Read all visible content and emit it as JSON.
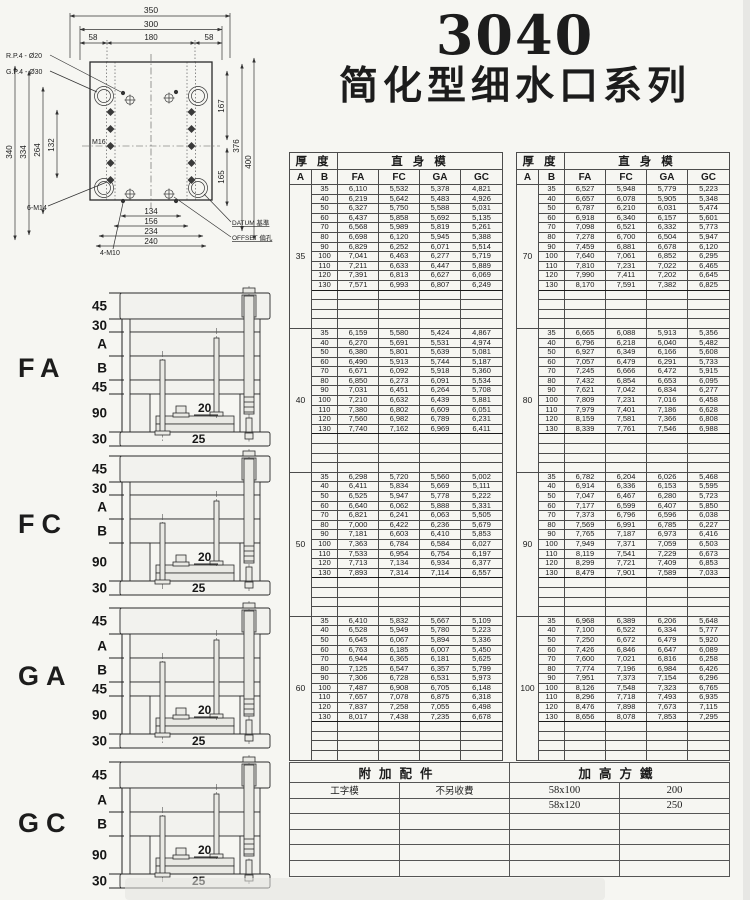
{
  "colors": {
    "paper": "#f6f6f2",
    "ink": "#1c1c1c"
  },
  "title": {
    "model": "3040",
    "series": "简化型细水口系列"
  },
  "drawing": {
    "dims_top": [
      "350",
      "300",
      "58",
      "180",
      "58"
    ],
    "dims_left": [
      "340",
      "334",
      "264",
      "132"
    ],
    "dims_right": [
      "167",
      "165",
      "376",
      "400"
    ],
    "dims_bottom": [
      "134",
      "156",
      "234",
      "240"
    ],
    "labels": {
      "rp4": "R.P.4 - Ø20",
      "gp4": "G.P.4 - Ø30",
      "m14": "6-M14",
      "m10": "4-M10",
      "m16": "M16",
      "datum": "DATUM 基準",
      "offset": "OFFSET 偏孔"
    }
  },
  "sections": [
    {
      "label": "FA",
      "dims": [
        "45",
        "30",
        "A",
        "B",
        "45",
        "90",
        "30"
      ],
      "inner": [
        "20",
        "25"
      ]
    },
    {
      "label": "FC",
      "dims": [
        "45",
        "30",
        "A",
        "B",
        "90",
        "30"
      ],
      "inner": [
        "20",
        "25"
      ]
    },
    {
      "label": "GA",
      "dims": [
        "45",
        "A",
        "B",
        "45",
        "90",
        "30"
      ],
      "inner": [
        "20",
        "25"
      ]
    },
    {
      "label": "GC",
      "dims": [
        "45",
        "A",
        "B",
        "90",
        "30"
      ],
      "inner": [
        "20",
        "25"
      ]
    }
  ],
  "price_tables": [
    {
      "header": {
        "thickness": "厚 度",
        "body": "直 身 模",
        "cols": [
          "A",
          "B",
          "FA",
          "FC",
          "GA",
          "GC"
        ]
      },
      "blocks": [
        {
          "a": "35",
          "empty_rows": 4,
          "rows": [
            [
              "35",
              "6,110",
              "5,532",
              "5,378",
              "4,821"
            ],
            [
              "40",
              "6,219",
              "5,642",
              "5,483",
              "4,926"
            ],
            [
              "50",
              "6,327",
              "5,750",
              "5,588",
              "5,031"
            ],
            [
              "60",
              "6,437",
              "5,858",
              "5,692",
              "5,135"
            ],
            [
              "70",
              "6,568",
              "5,989",
              "5,819",
              "5,261"
            ],
            [
              "80",
              "6,698",
              "6,120",
              "5,945",
              "5,388"
            ],
            [
              "90",
              "6,829",
              "6,252",
              "6,071",
              "5,514"
            ],
            [
              "100",
              "7,041",
              "6,463",
              "6,277",
              "5,719"
            ],
            [
              "110",
              "7,211",
              "6,633",
              "6,447",
              "5,889"
            ],
            [
              "120",
              "7,391",
              "6,813",
              "6,627",
              "6,069"
            ],
            [
              "130",
              "7,571",
              "6,993",
              "6,807",
              "6,249"
            ]
          ]
        },
        {
          "a": "40",
          "empty_rows": 4,
          "rows": [
            [
              "35",
              "6,159",
              "5,580",
              "5,424",
              "4,867"
            ],
            [
              "40",
              "6,270",
              "5,691",
              "5,531",
              "4,974"
            ],
            [
              "50",
              "6,380",
              "5,801",
              "5,639",
              "5,081"
            ],
            [
              "60",
              "6,490",
              "5,913",
              "5,744",
              "5,187"
            ],
            [
              "70",
              "6,671",
              "6,092",
              "5,918",
              "5,360"
            ],
            [
              "80",
              "6,850",
              "6,273",
              "6,091",
              "5,534"
            ],
            [
              "90",
              "7,031",
              "6,451",
              "6,264",
              "5,708"
            ],
            [
              "100",
              "7,210",
              "6,632",
              "6,439",
              "5,881"
            ],
            [
              "110",
              "7,380",
              "6,802",
              "6,609",
              "6,051"
            ],
            [
              "120",
              "7,560",
              "6,982",
              "6,789",
              "6,231"
            ],
            [
              "130",
              "7,740",
              "7,162",
              "6,969",
              "6,411"
            ]
          ]
        },
        {
          "a": "50",
          "empty_rows": 4,
          "rows": [
            [
              "35",
              "6,298",
              "5,720",
              "5,560",
              "5,002"
            ],
            [
              "40",
              "6,411",
              "5,834",
              "5,669",
              "5,111"
            ],
            [
              "50",
              "6,525",
              "5,947",
              "5,778",
              "5,222"
            ],
            [
              "60",
              "6,640",
              "6,062",
              "5,888",
              "5,331"
            ],
            [
              "70",
              "6,821",
              "6,241",
              "6,063",
              "5,505"
            ],
            [
              "80",
              "7,000",
              "6,422",
              "6,236",
              "5,679"
            ],
            [
              "90",
              "7,181",
              "6,603",
              "6,410",
              "5,853"
            ],
            [
              "100",
              "7,363",
              "6,784",
              "6,584",
              "6,027"
            ],
            [
              "110",
              "7,533",
              "6,954",
              "6,754",
              "6,197"
            ],
            [
              "120",
              "7,713",
              "7,134",
              "6,934",
              "6,377"
            ],
            [
              "130",
              "7,893",
              "7,314",
              "7,114",
              "6,557"
            ]
          ]
        },
        {
          "a": "60",
          "empty_rows": 4,
          "rows": [
            [
              "35",
              "6,410",
              "5,832",
              "5,667",
              "5,109"
            ],
            [
              "40",
              "6,528",
              "5,949",
              "5,780",
              "5,223"
            ],
            [
              "50",
              "6,645",
              "6,067",
              "5,894",
              "5,336"
            ],
            [
              "60",
              "6,763",
              "6,185",
              "6,007",
              "5,450"
            ],
            [
              "70",
              "6,944",
              "6,365",
              "6,181",
              "5,625"
            ],
            [
              "80",
              "7,125",
              "6,547",
              "6,357",
              "5,799"
            ],
            [
              "90",
              "7,306",
              "6,728",
              "6,531",
              "5,973"
            ],
            [
              "100",
              "7,487",
              "6,908",
              "6,705",
              "6,148"
            ],
            [
              "110",
              "7,657",
              "7,078",
              "6,875",
              "6,318"
            ],
            [
              "120",
              "7,837",
              "7,258",
              "7,055",
              "6,498"
            ],
            [
              "130",
              "8,017",
              "7,438",
              "7,235",
              "6,678"
            ]
          ]
        }
      ]
    },
    {
      "header": {
        "thickness": "厚 度",
        "body": "直 身 模",
        "cols": [
          "A",
          "B",
          "FA",
          "FC",
          "GA",
          "GC"
        ]
      },
      "blocks": [
        {
          "a": "70",
          "empty_rows": 4,
          "rows": [
            [
              "35",
              "6,527",
              "5,948",
              "5,779",
              "5,223"
            ],
            [
              "40",
              "6,657",
              "6,078",
              "5,905",
              "5,348"
            ],
            [
              "50",
              "6,787",
              "6,210",
              "6,031",
              "5,474"
            ],
            [
              "60",
              "6,918",
              "6,340",
              "6,157",
              "5,601"
            ],
            [
              "70",
              "7,098",
              "6,521",
              "6,332",
              "5,773"
            ],
            [
              "80",
              "7,278",
              "6,700",
              "6,504",
              "5,947"
            ],
            [
              "90",
              "7,459",
              "6,881",
              "6,678",
              "6,120"
            ],
            [
              "100",
              "7,640",
              "7,061",
              "6,852",
              "6,295"
            ],
            [
              "110",
              "7,810",
              "7,231",
              "7,022",
              "6,465"
            ],
            [
              "120",
              "7,990",
              "7,411",
              "7,202",
              "6,645"
            ],
            [
              "130",
              "8,170",
              "7,591",
              "7,382",
              "6,825"
            ]
          ]
        },
        {
          "a": "80",
          "empty_rows": 4,
          "rows": [
            [
              "35",
              "6,665",
              "6,088",
              "5,913",
              "5,356"
            ],
            [
              "40",
              "6,796",
              "6,218",
              "6,040",
              "5,482"
            ],
            [
              "50",
              "6,927",
              "6,349",
              "6,166",
              "5,608"
            ],
            [
              "60",
              "7,057",
              "6,479",
              "6,291",
              "5,733"
            ],
            [
              "70",
              "7,245",
              "6,666",
              "6,472",
              "5,915"
            ],
            [
              "80",
              "7,432",
              "6,854",
              "6,653",
              "6,095"
            ],
            [
              "90",
              "7,621",
              "7,042",
              "6,834",
              "6,277"
            ],
            [
              "100",
              "7,809",
              "7,231",
              "7,016",
              "6,458"
            ],
            [
              "110",
              "7,979",
              "7,401",
              "7,186",
              "6,628"
            ],
            [
              "120",
              "8,159",
              "7,581",
              "7,366",
              "6,808"
            ],
            [
              "130",
              "8,339",
              "7,761",
              "7,546",
              "6,988"
            ]
          ]
        },
        {
          "a": "90",
          "empty_rows": 4,
          "rows": [
            [
              "35",
              "6,782",
              "6,204",
              "6,026",
              "5,468"
            ],
            [
              "40",
              "6,914",
              "6,336",
              "6,153",
              "5,595"
            ],
            [
              "50",
              "7,047",
              "6,467",
              "6,280",
              "5,723"
            ],
            [
              "60",
              "7,177",
              "6,599",
              "6,407",
              "5,850"
            ],
            [
              "70",
              "7,373",
              "6,796",
              "6,596",
              "6,038"
            ],
            [
              "80",
              "7,569",
              "6,991",
              "6,785",
              "6,227"
            ],
            [
              "90",
              "7,765",
              "7,187",
              "6,973",
              "6,416"
            ],
            [
              "100",
              "7,949",
              "7,371",
              "7,059",
              "6,503"
            ],
            [
              "110",
              "8,119",
              "7,541",
              "7,229",
              "6,673"
            ],
            [
              "120",
              "8,299",
              "7,721",
              "7,409",
              "6,853"
            ],
            [
              "130",
              "8,479",
              "7,901",
              "7,589",
              "7,033"
            ]
          ]
        },
        {
          "a": "100",
          "empty_rows": 4,
          "rows": [
            [
              "35",
              "6,968",
              "6,389",
              "6,206",
              "5,648"
            ],
            [
              "40",
              "7,100",
              "6,522",
              "6,334",
              "5,777"
            ],
            [
              "50",
              "7,250",
              "6,672",
              "6,479",
              "5,920"
            ],
            [
              "60",
              "7,426",
              "6,846",
              "6,647",
              "6,089"
            ],
            [
              "70",
              "7,600",
              "7,021",
              "6,816",
              "6,258"
            ],
            [
              "80",
              "7,774",
              "7,196",
              "6,984",
              "6,426"
            ],
            [
              "90",
              "7,951",
              "7,373",
              "7,154",
              "6,296"
            ],
            [
              "100",
              "8,126",
              "7,548",
              "7,323",
              "6,765"
            ],
            [
              "110",
              "8,296",
              "7,718",
              "7,493",
              "6,935"
            ],
            [
              "120",
              "8,476",
              "7,898",
              "7,673",
              "7,115"
            ],
            [
              "130",
              "8,656",
              "8,078",
              "7,853",
              "7,295"
            ]
          ]
        }
      ]
    }
  ],
  "accessory_table": {
    "left_header": "附加配件",
    "right_header": "加高方鐵",
    "rows": [
      [
        "工字模",
        "不另收費",
        "58x100",
        "200"
      ],
      [
        "",
        "",
        "58x120",
        "250"
      ],
      [
        "",
        "",
        "",
        ""
      ],
      [
        "",
        "",
        "",
        ""
      ],
      [
        "",
        "",
        "",
        ""
      ],
      [
        "",
        "",
        "",
        ""
      ]
    ]
  }
}
